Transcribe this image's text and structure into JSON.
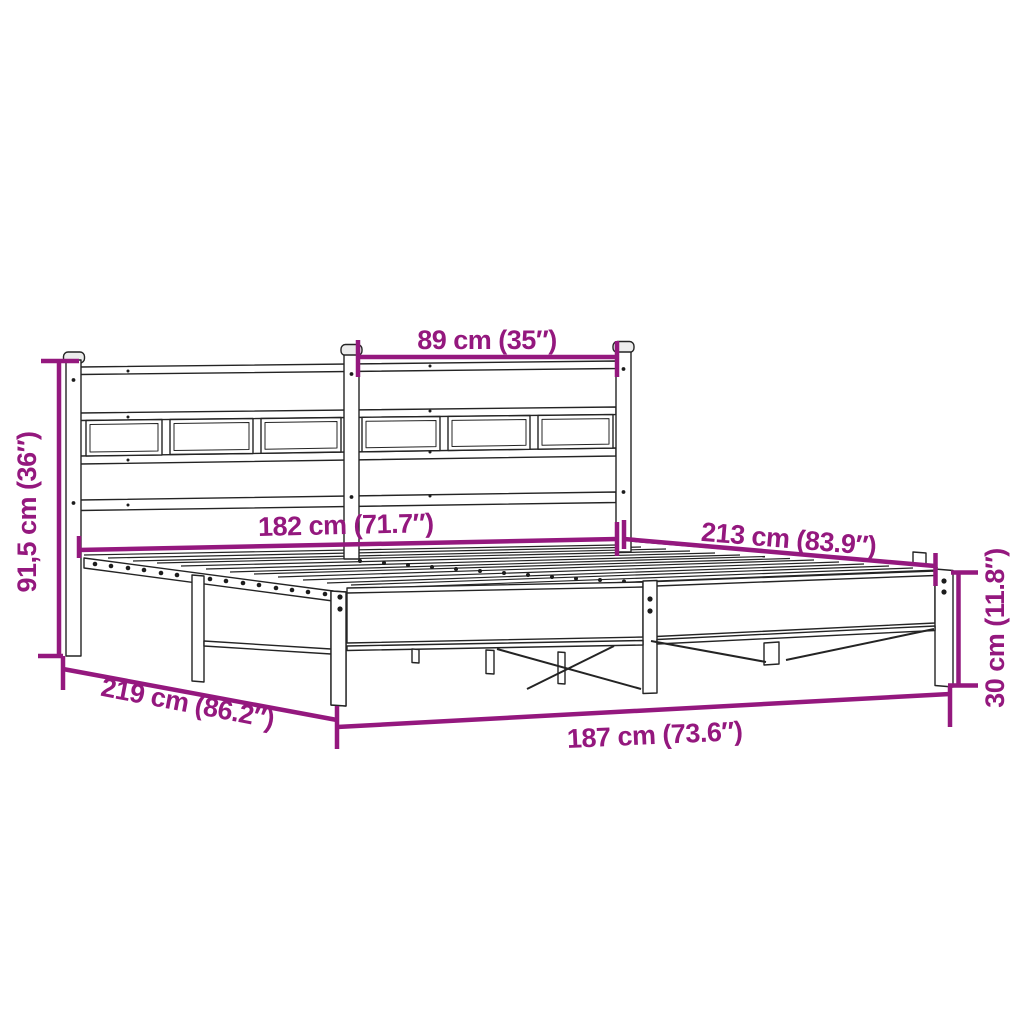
{
  "diagram": {
    "subject": "metal bed frame with headboard - product dimension diagram",
    "colors": {
      "dimension": "#94187E",
      "outline": "#242424",
      "background": "#FFFFFF"
    },
    "labels": {
      "headboard_section_width": "89 cm (35″)",
      "headboard_height": "91,5 cm (36″)",
      "slat_area_length": "182 cm (71.7″)",
      "total_length": "213 cm (83.9″)",
      "diagonal_depth": "219 cm (86.2″)",
      "total_width": "187 cm (73.6″)",
      "frame_height": "30 cm (11.8″)"
    }
  }
}
